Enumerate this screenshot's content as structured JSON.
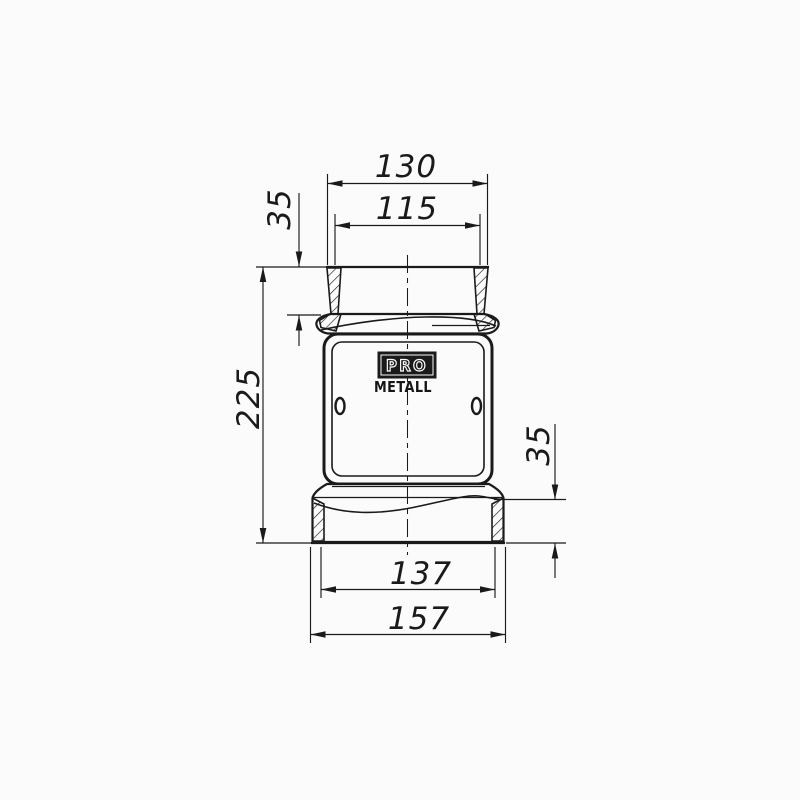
{
  "page": {
    "background": "#fbfbfb",
    "ink": "#1a1a1a",
    "type": "technical-drawing"
  },
  "logo": {
    "line1": "PRO",
    "line2": "METALL"
  },
  "dimensions": {
    "top_outer_width": "130",
    "top_inner_width": "115",
    "neck_height": "35",
    "overall_height": "225",
    "base_height": "35",
    "base_inner_width": "137",
    "base_outer_width": "157"
  }
}
